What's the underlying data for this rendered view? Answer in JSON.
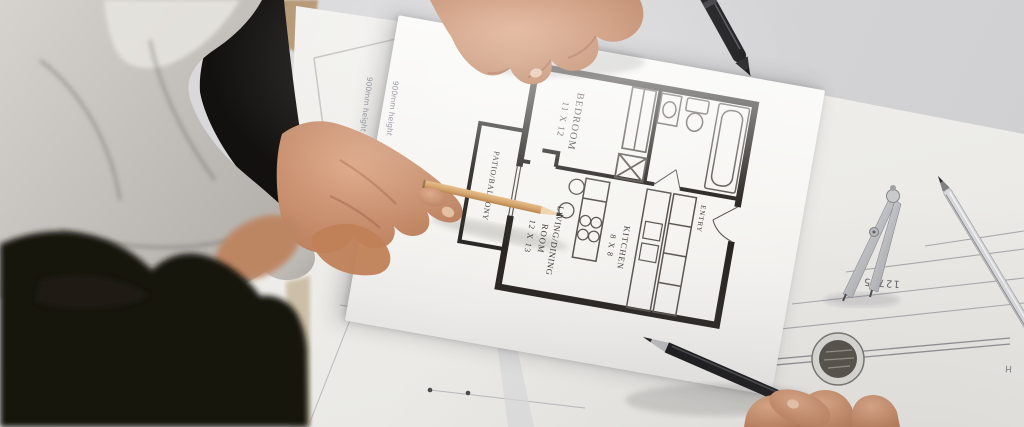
{
  "scene": {
    "description": "Overhead photo of an architect pointing with a wooden pencil at an apartment floor-plan sheet on a desk covered with blueprints and drafting tools, while a second person (dark hair, foreground) looks on"
  },
  "floor_plan": {
    "rooms": [
      {
        "label": "BEDROOM",
        "dims": "11 X 12"
      },
      {
        "label": "LIVING/DINING",
        "label2": "ROOM",
        "dims": "12 X 13"
      },
      {
        "label": "KITCHEN",
        "dims": "8 X 8"
      },
      {
        "label": "PATIO/BALCONY"
      },
      {
        "label": "ENTRY"
      }
    ]
  },
  "blueprint_notes": {
    "note1": "900mm height",
    "note2": "900mm height",
    "measurement": "12785",
    "letter": "H"
  },
  "colors": {
    "background": "#d6d5d7",
    "paper": "#eeede9",
    "plan_sheet": "#f6f5f2",
    "wall_ink": "#24211d",
    "skin": "#c9906f",
    "sweater": "#c9c6c1",
    "hair": "#17100d",
    "pencil_wood": "#d8a96e"
  }
}
